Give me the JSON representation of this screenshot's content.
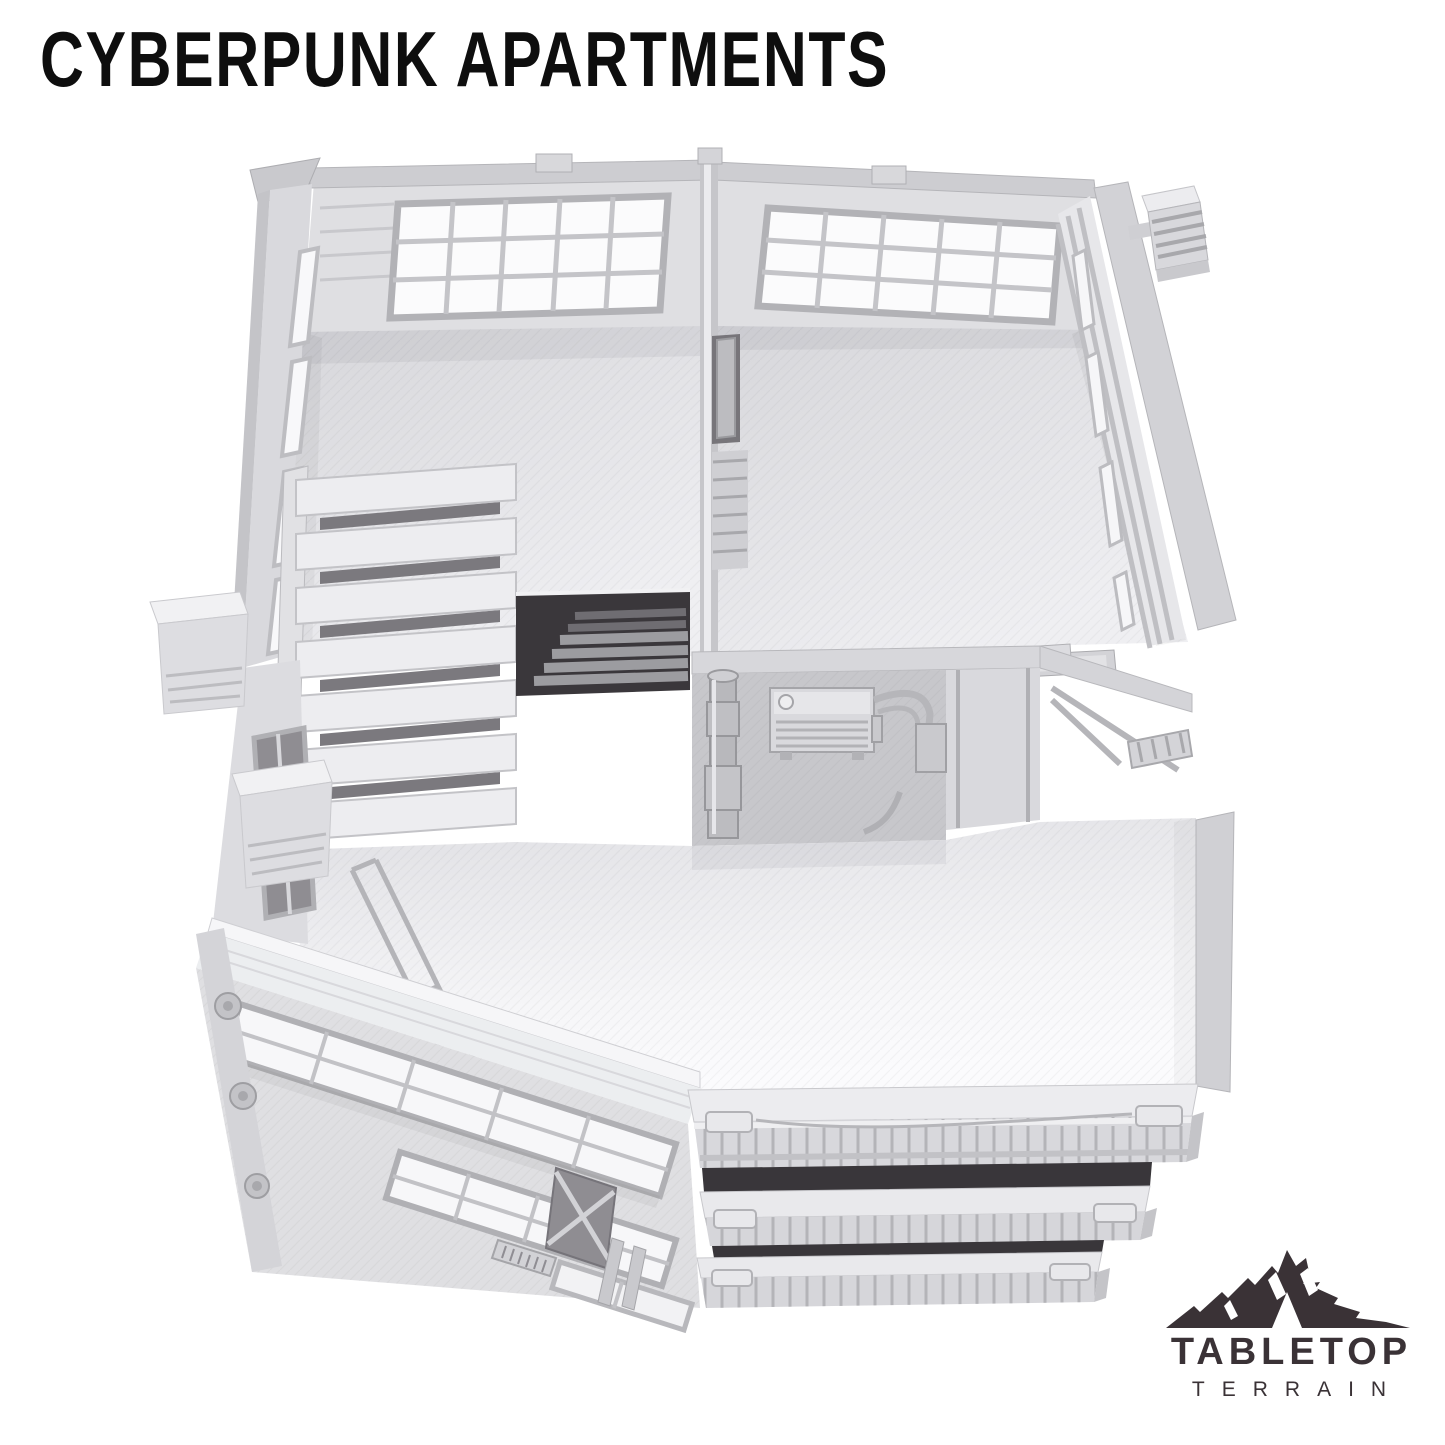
{
  "page": {
    "background": "#ffffff"
  },
  "header": {
    "title": "CYBERPUNK APARTMENTS",
    "title_color": "#0e0e0e"
  },
  "product_photo": {
    "alt": "Light gray 3D-printed cyberpunk apartment terrain building seen from above, with two open-top rooms, louvered stair canopy, rooftop terrace, window facades and stacked balconies",
    "filament_color": "#dcdcdf",
    "floor_highlight_color": "#f8f8fa",
    "void_color": "#39363a"
  },
  "logo": {
    "name": "TABLETOP",
    "tagline": "TERRAIN",
    "color": "#3a3236"
  }
}
